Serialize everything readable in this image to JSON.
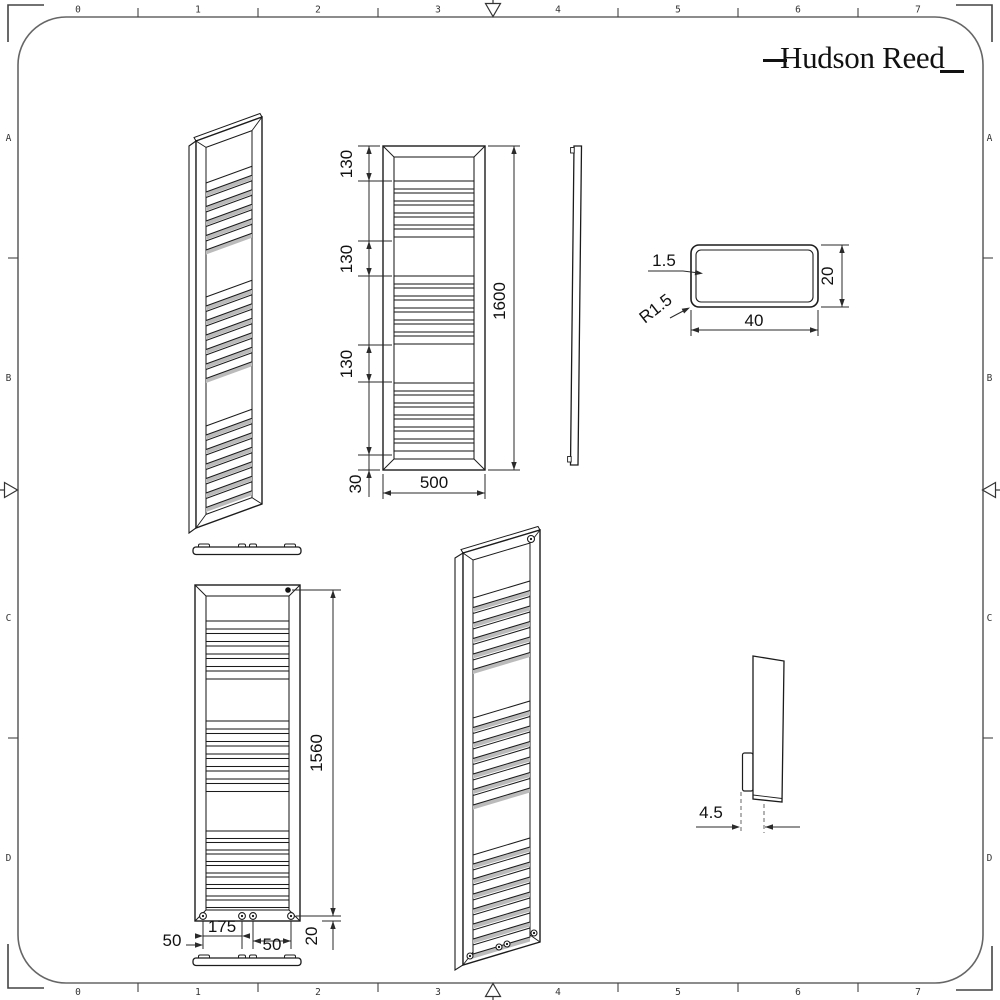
{
  "brand": {
    "logo_text": "Hudson Reed"
  },
  "ruler": {
    "top": [
      "0",
      "1",
      "2",
      "3",
      "4",
      "5",
      "6",
      "7"
    ],
    "bottom": [
      "0",
      "1",
      "2",
      "3",
      "4",
      "5",
      "6",
      "7"
    ],
    "left": [
      "A",
      "B",
      "C",
      "D"
    ],
    "right": [
      "A",
      "B",
      "C",
      "D"
    ]
  },
  "dimensions": {
    "front": {
      "top_gap": "130",
      "mid_gap": "130",
      "low_gap": "130",
      "bottom_gap": "30",
      "height": "1600",
      "width": "500"
    },
    "section": {
      "wall_thickness": "1.5",
      "corner_radius": "R1.5",
      "width": "40",
      "height": "20"
    },
    "rear": {
      "fixing_height": "1560",
      "left_offset": "50",
      "fixing_centres": "175",
      "right_offset": "50",
      "bottom_offset": "20"
    },
    "side": {
      "bracket_depth": "4.5"
    }
  },
  "colors": {
    "line": "#1c1c1c",
    "dim": "#2a2a2a",
    "border": "#666666",
    "shadow": "#bbbbbb",
    "background": "#ffffff"
  }
}
